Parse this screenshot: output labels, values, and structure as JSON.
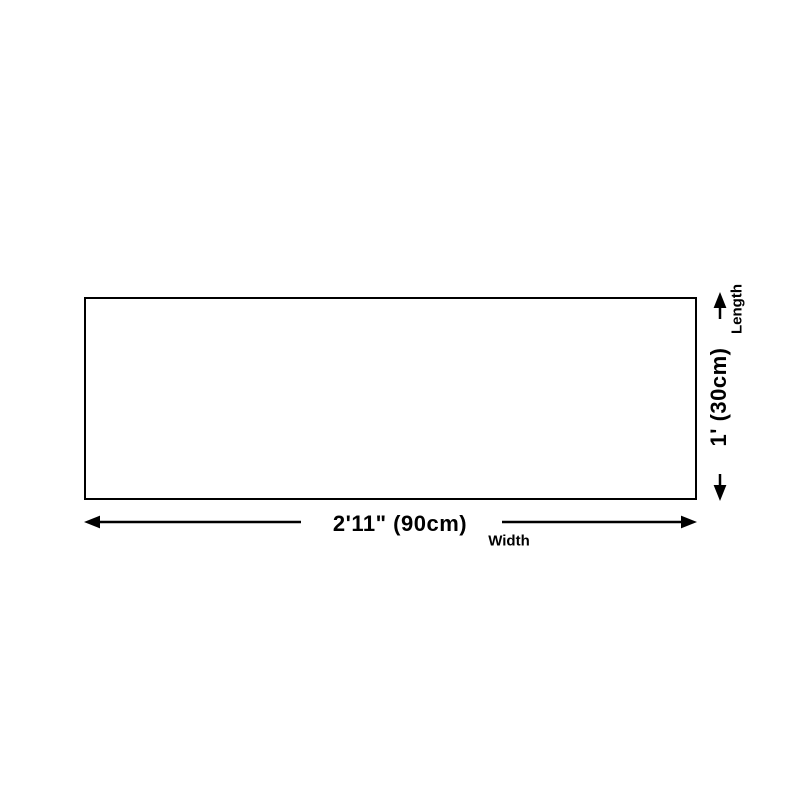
{
  "diagram": {
    "title_hint": "product-dimension-diagram",
    "width": {
      "value": "2'11\" (90cm)",
      "label": "Width"
    },
    "length": {
      "value": "1' (30cm)",
      "label": "Length"
    },
    "icons": {
      "width_arrow_left": "arrow-left",
      "width_arrow_right": "arrow-right",
      "length_arrow_up": "arrow-up",
      "length_arrow_down": "arrow-down"
    },
    "colors": {
      "line": "#000000",
      "background": "#ffffff"
    }
  }
}
